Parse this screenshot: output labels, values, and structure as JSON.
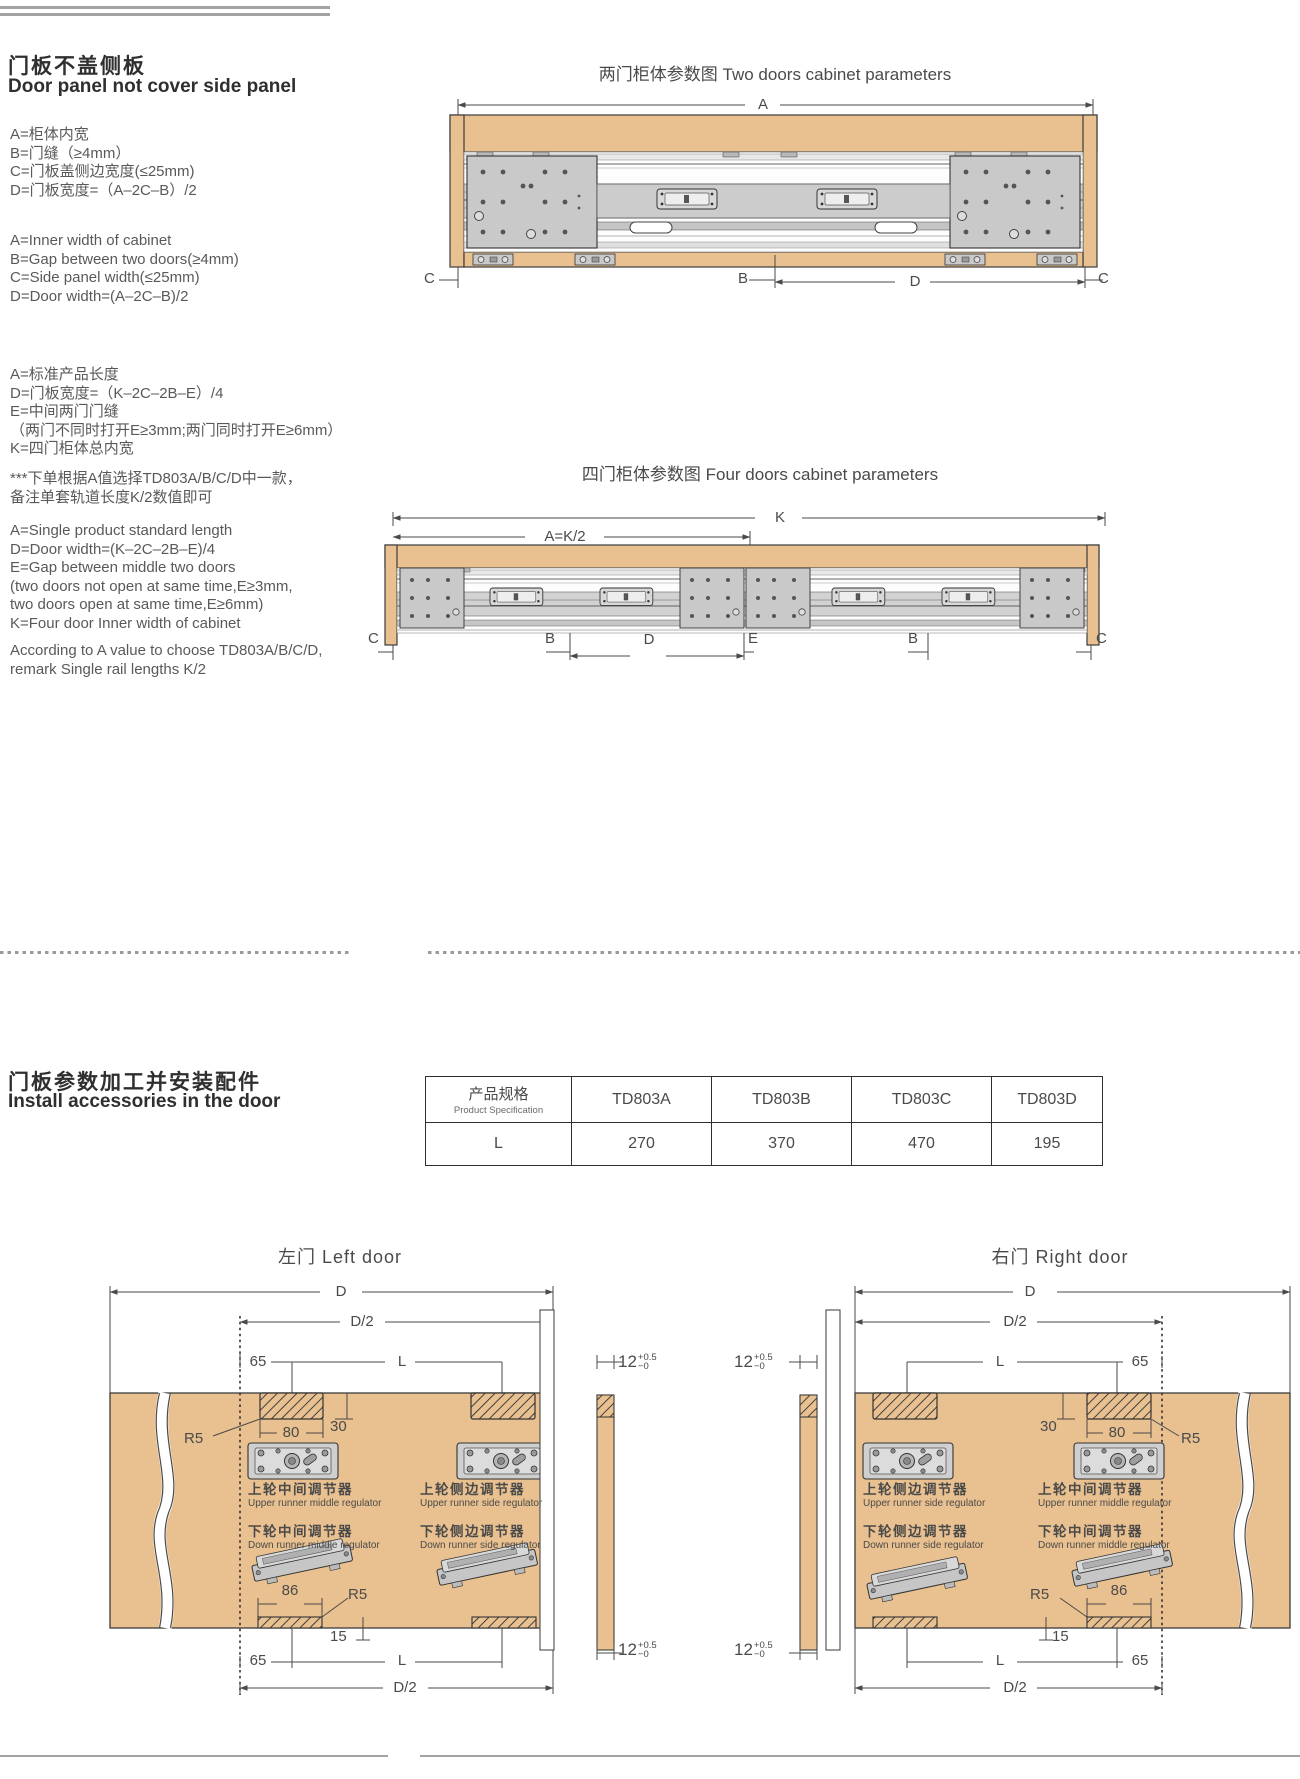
{
  "intro": {
    "title_cn": "门板不盖侧板",
    "title_en": "Door panel not cover side panel",
    "cn1": [
      "A=柜体内宽",
      "B=门缝（≥4mm）",
      "C=门板盖侧边宽度(≤25mm)",
      "D=门板宽度=（A–2C–B）/2"
    ],
    "en1": [
      "A=Inner width of cabinet",
      "B=Gap between two doors(≥4mm)",
      "C=Side panel width(≤25mm)",
      "D=Door width=(A–2C–B)/2"
    ],
    "cn2": [
      "A=标准产品长度",
      "D=门板宽度=（K–2C–2B–E）/4",
      "E=中间两门门缝",
      "（两门不同时打开E≥3mm;两门同时打开E≥6mm）",
      "K=四门柜体总内宽"
    ],
    "cn3": [
      "***下单根据A值选择TD803A/B/C/D中一款，",
      "备注单套轨道长度K/2数值即可"
    ],
    "en2": [
      "A=Single product standard length",
      "D=Door width=(K–2C–2B–E)/4",
      "E=Gap between middle two doors",
      "(two doors not open at same time,E≥3mm,",
      "two doors open at same time,E≥6mm)",
      "K=Four door Inner width of cabinet"
    ],
    "en3": [
      "According to A value to choose TD803A/B/C/D,",
      "remark Single rail lengths K/2"
    ]
  },
  "two_door": {
    "title": "两门柜体参数图 Two doors cabinet parameters",
    "dim_A": "A",
    "dim_B": "B",
    "dim_C_left": "C",
    "dim_C_right": "C",
    "dim_D": "D"
  },
  "four_door": {
    "title": "四门柜体参数图 Four doors cabinet parameters",
    "dim_K": "K",
    "dim_A": "A=K/2",
    "dim_C_left": "C",
    "dim_B_left": "B",
    "dim_D": "D",
    "dim_E": "E",
    "dim_B_right": "B",
    "dim_C_right": "C"
  },
  "install": {
    "title_cn": "门板参数加工并安装配件",
    "title_en": "Install accessories in the door"
  },
  "spec_table": {
    "header_cn": "产品规格",
    "header_en": "Product Specification",
    "models": [
      "TD803A",
      "TD803B",
      "TD803C",
      "TD803D"
    ],
    "row_label": "L",
    "lengths": [
      "270",
      "370",
      "470",
      "195"
    ]
  },
  "doors": {
    "left_title": "左门 Left door",
    "right_title": "右门 Right door",
    "dim_D": "D",
    "dim_D2": "D/2",
    "dim_65": "65",
    "dim_L": "L",
    "dim_80": "80",
    "dim_30": "30",
    "dim_R5": "R5",
    "dim_86": "86",
    "dim_15": "15",
    "tol": {
      "v": "12",
      "sup": "+0.5",
      "sub": "−0"
    },
    "reg": {
      "upper_middle_cn": "上轮中间调节器",
      "upper_middle_en": "Upper runner middle regulator",
      "upper_side_cn": "上轮侧边调节器",
      "upper_side_en": "Upper runner side regulator",
      "down_middle_cn": "下轮中间调节器",
      "down_middle_en": "Down runner middle regulator",
      "down_side_cn": "下轮侧边调节器",
      "down_side_en": "Down runner side regulator"
    }
  },
  "colors": {
    "wood": "#e9c08f",
    "steel": "#c9c9c9",
    "line": "#4a4a4a"
  }
}
